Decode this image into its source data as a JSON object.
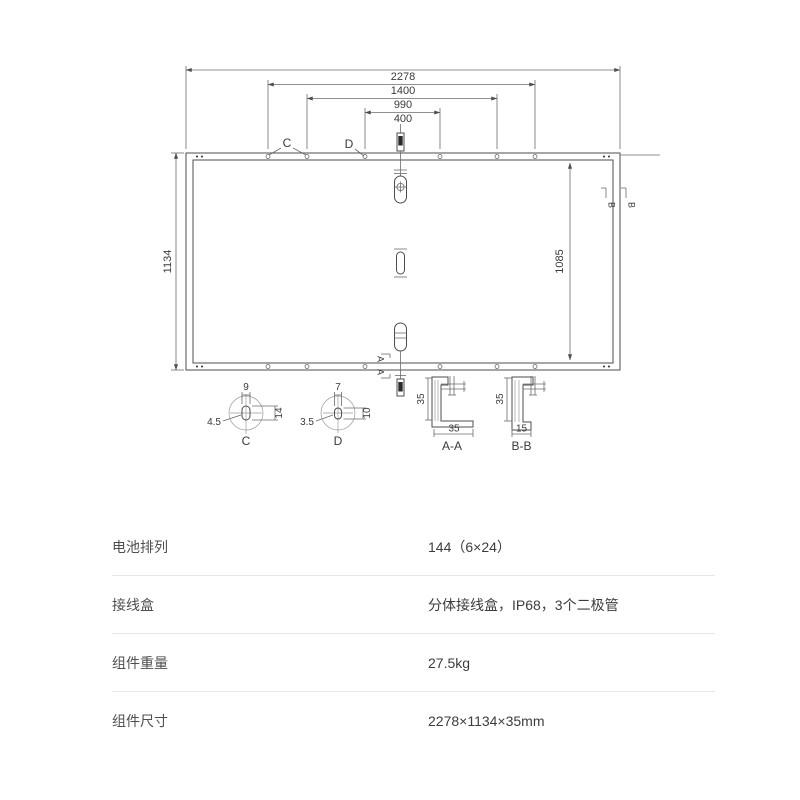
{
  "colors": {
    "line": "#4d4d4d",
    "divider": "#e7e7e7",
    "text": "#3d3d3d"
  },
  "drawing": {
    "top_dims": [
      "2278",
      "1400",
      "990",
      "400"
    ],
    "side_dims": {
      "left": "1134",
      "right": "1085"
    },
    "hole_labels": {
      "c": "C",
      "d": "D"
    },
    "details": {
      "c": {
        "label": "C",
        "slot_width": "9",
        "slot_height": "14",
        "corner_radius": "4.5"
      },
      "d": {
        "label": "D",
        "slot_width": "7",
        "slot_height": "10",
        "corner_radius": "3.5"
      }
    },
    "sections": {
      "aa": {
        "label": "A-A",
        "marker": "A",
        "height": "35",
        "width": "35"
      },
      "bb": {
        "label": "B-B",
        "marker": "B",
        "height": "35",
        "width": "15"
      }
    }
  },
  "table": {
    "rows": [
      {
        "label": "电池排列",
        "value": "144（6×24）"
      },
      {
        "label": "接线盒",
        "value": "分体接线盒，IP68，3个二极管"
      },
      {
        "label": "组件重量",
        "value": "27.5kg"
      },
      {
        "label": "组件尺寸",
        "value": "2278×1134×35mm"
      }
    ]
  }
}
